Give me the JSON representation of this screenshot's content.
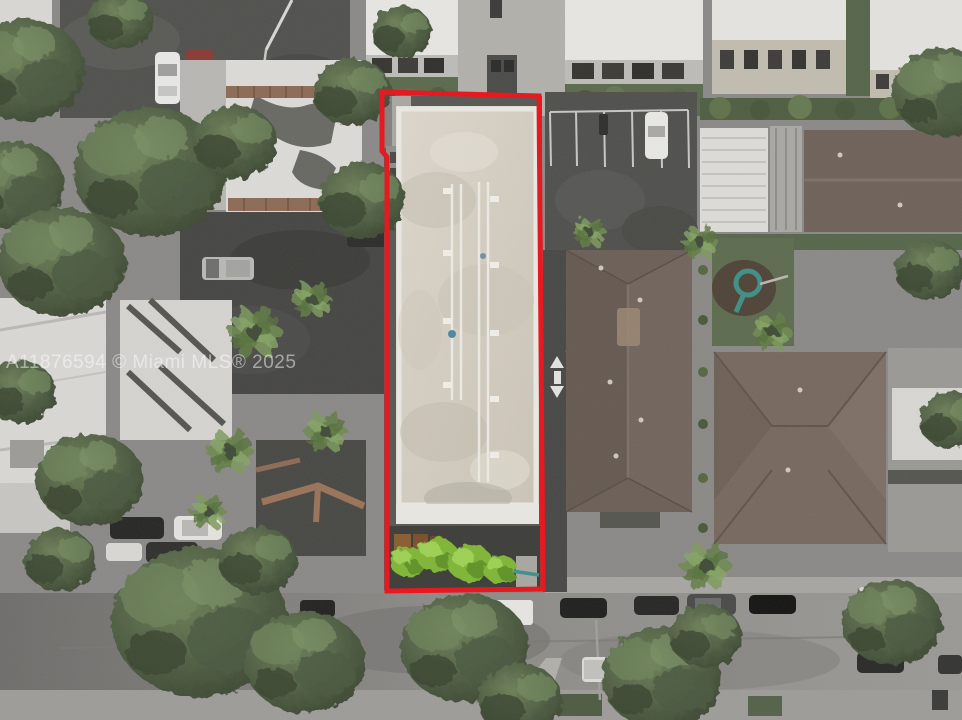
{
  "image": {
    "type": "aerial-drone-photograph",
    "description": "Overhead aerial/drone view of an urban block; a long flat-roofed commercial building parcel is outlined in red (real-estate listing photo).",
    "watermark": "A11876594 © Miami MLS® 2025"
  },
  "colors": {
    "boundary_red": "#e8121a",
    "subject_roof_cream": "#d8d2c8",
    "subject_parapet": "#eae8e2",
    "brown_roof": "#6b5f57",
    "brown_roof_light": "#76685e",
    "terracotta": "#8d6a55",
    "asphalt_dark": "#4c4c49",
    "street_gray": "#8b8a86",
    "sidewalk": "#9d9c98",
    "building_white": "#e6e5e2",
    "foliage_dark": "#3f4c37",
    "foliage_bright": "#7fb636",
    "lawn_green": "#5c6b4e"
  },
  "boundary": {
    "label": "subject-property-outline",
    "stroke_width": 5
  }
}
